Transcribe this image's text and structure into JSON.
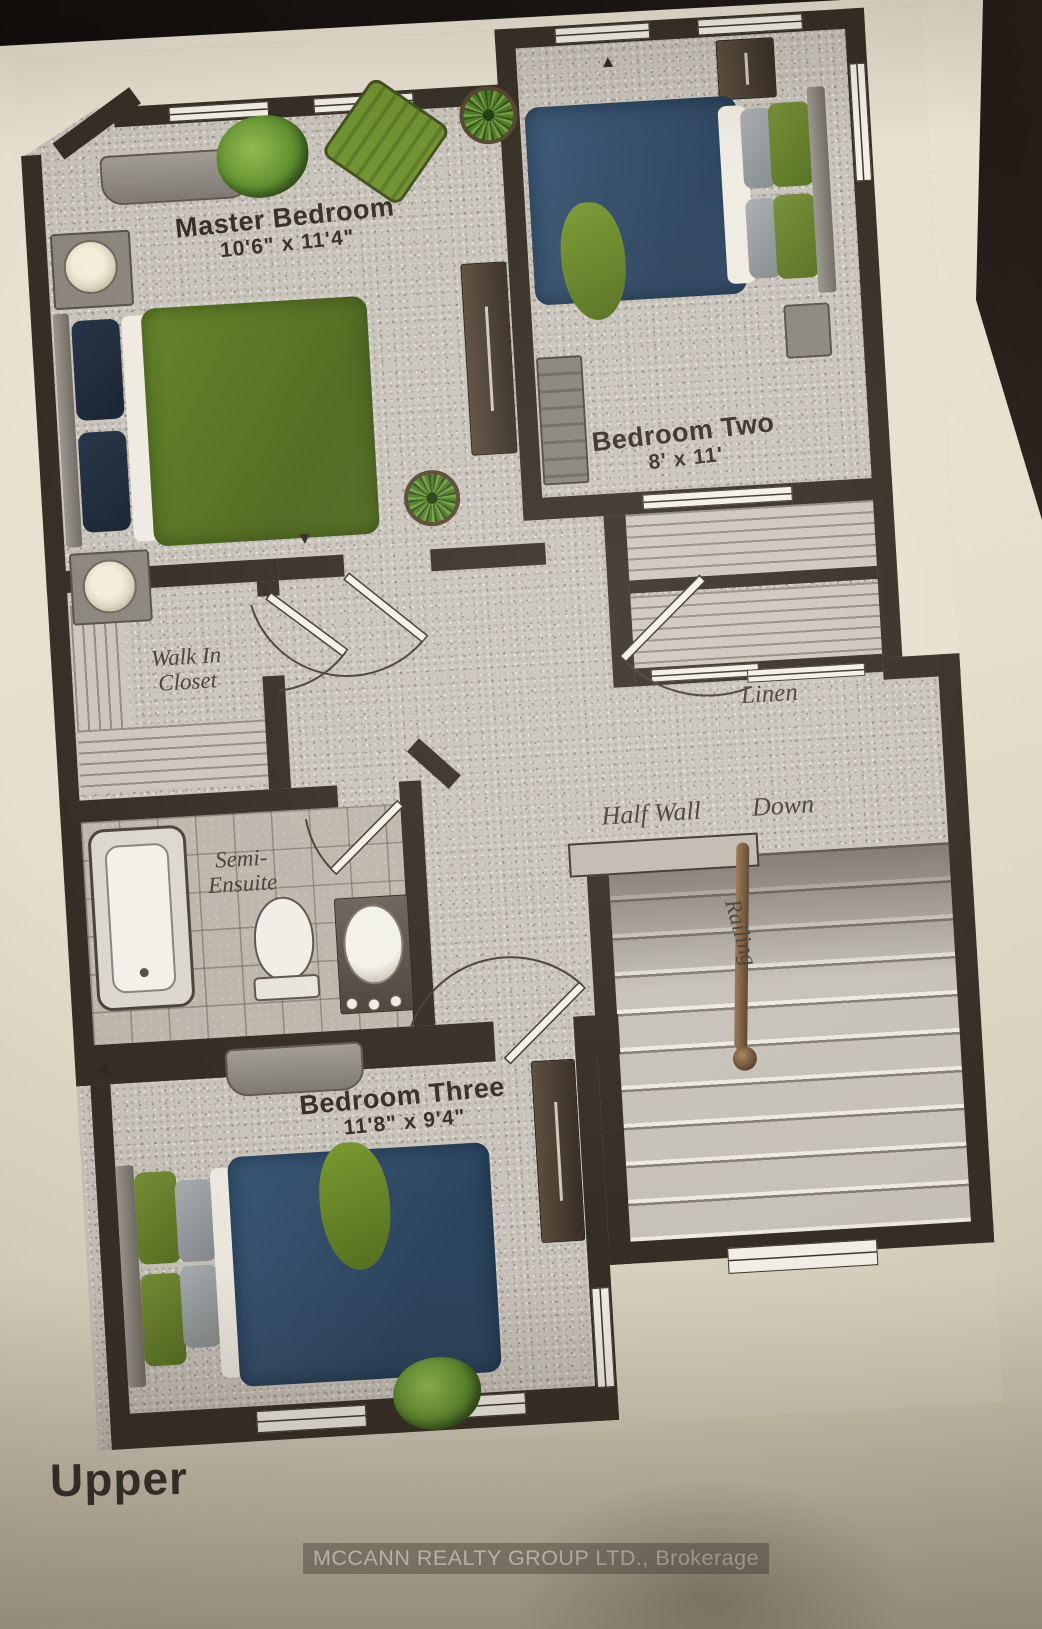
{
  "floor_plan": {
    "title": "Upper",
    "brokerage": "MCCANN REALTY GROUP LTD., Brokerage",
    "rooms": [
      {
        "name": "Master Bedroom",
        "dimensions": "10'6\" x 11'4\""
      },
      {
        "name": "Bedroom Two",
        "dimensions": "8' x 11'"
      },
      {
        "name": "Bedroom Three",
        "dimensions": "11'8\" x 9'4\""
      }
    ],
    "areas": {
      "walk_in_closet": "Walk In Closet",
      "semi_ensuite": "Semi-Ensuite",
      "linen": "Linen",
      "half_wall": "Half Wall",
      "down": "Down",
      "railing": "Railing"
    },
    "markers": {
      "up": "▲",
      "down": "▼",
      "left": "◀"
    },
    "colors": {
      "wall": "#352e24",
      "carpet": "#c9c4bb",
      "tile": "#bcb6ab",
      "paper": "#e5decd",
      "photo_background": "#171310",
      "master_bed_green": "#5d7b21",
      "guest_bed_blue": "#33506c",
      "plant_green": "#5f8f2e",
      "railing_brown": "#7a5b3a",
      "room_label_text": "#372f25",
      "annotation_text": "#463f35",
      "footer_text": "#f0ece1"
    }
  }
}
